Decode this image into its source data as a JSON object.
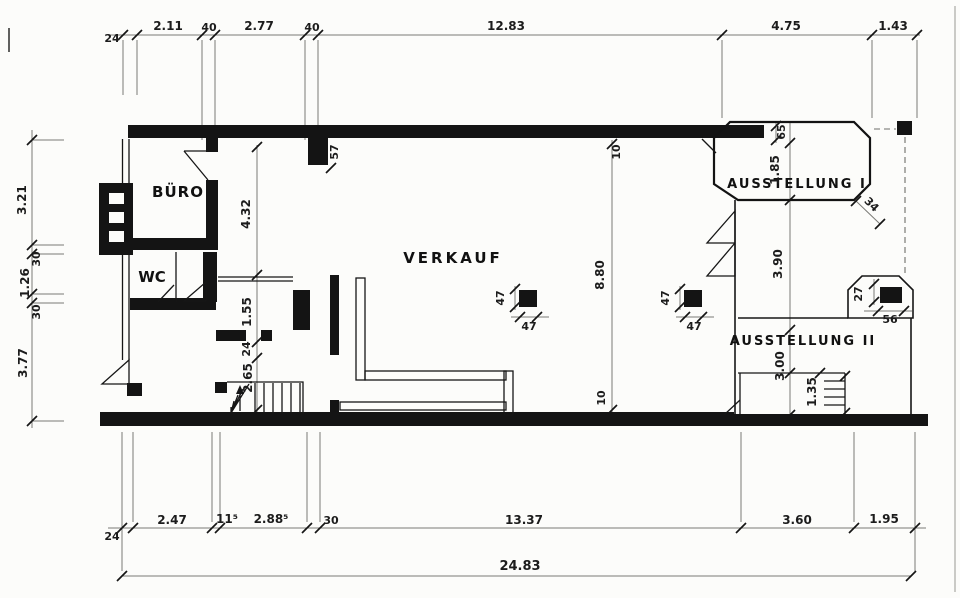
{
  "rooms": {
    "buero": "BÜRO",
    "wc": "WC",
    "verkauf": "VERKAUF",
    "ausstellung1": "AUSSTELLUNG I",
    "ausstellung2": "AUSSTELLUNG II"
  },
  "dims": {
    "top": {
      "wall": "24",
      "a": "2.11",
      "b": "40",
      "c": "2.77",
      "d": "40",
      "e": "12.83",
      "f": "4.75",
      "g": "1.43"
    },
    "bottom": {
      "wall": "24",
      "a": "2.47",
      "b": "11⁵",
      "c": "2.88⁵",
      "d": "30",
      "e": "13.37",
      "f": "3.60",
      "g": "1.95",
      "total": "24.83"
    },
    "left": {
      "a": "3.21",
      "b": "30",
      "c": "1.26",
      "d": "30",
      "e": "3.77"
    },
    "corridor": {
      "a": "4.32",
      "b": "1.55",
      "c": "24",
      "d": "2.65"
    },
    "hall": {
      "top": "10",
      "height": "8.80",
      "bottom": "10",
      "pier": "57"
    },
    "columns": {
      "size": "47"
    },
    "display": {
      "ledge": "65",
      "height": "1.85",
      "chamfer": "34"
    },
    "exhibit": {
      "a": "3.90",
      "b": "3.00",
      "c": "1.35",
      "col_h": "27",
      "col_w": "56"
    }
  },
  "colors": {
    "ink": "#1a1a1a",
    "paper": "#fcfcfa",
    "dim_line": "#7a7a76"
  }
}
